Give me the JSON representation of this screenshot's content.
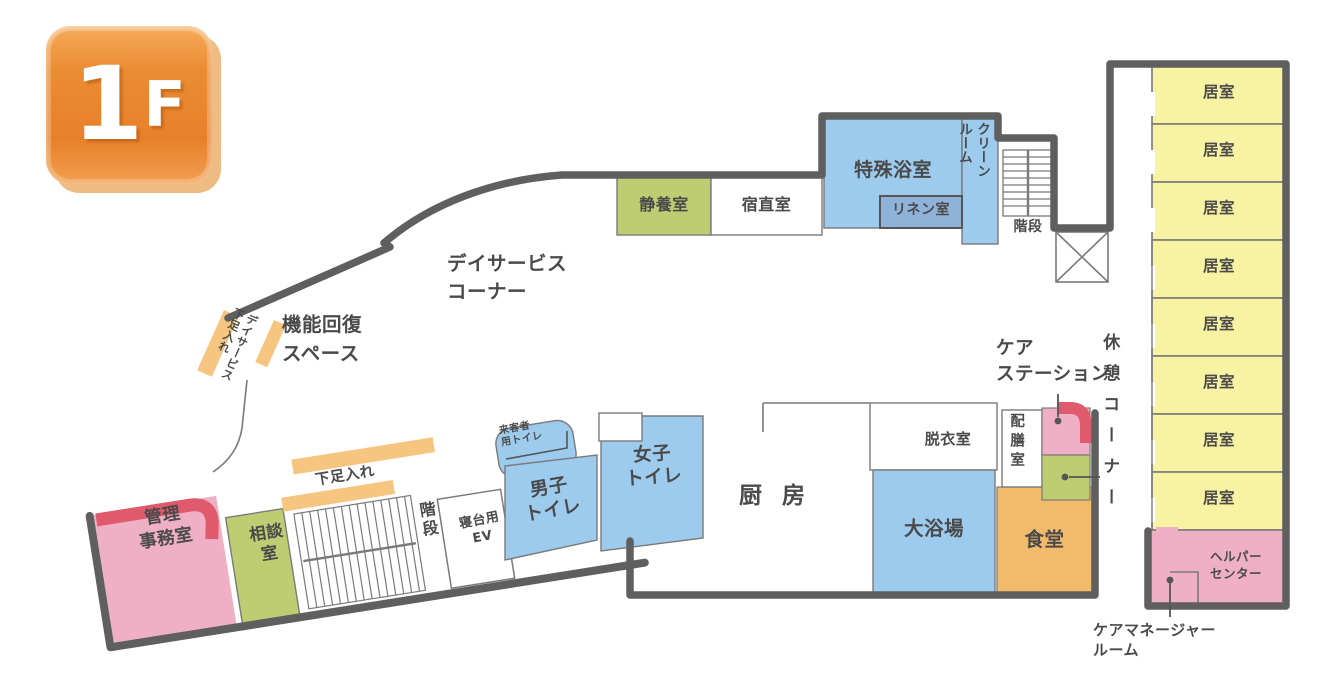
{
  "floor_badge": {
    "number": "1",
    "suffix": "F"
  },
  "colors": {
    "wall_thick": "#5f5f5f",
    "wall_thin": "#7a7a7a",
    "room_yellow": "#f8f2a3",
    "room_blue": "#9dcbee",
    "room_blue_dark": "#8fb2d9",
    "room_green": "#becd72",
    "room_orange": "#f2bb6c",
    "strip_orange": "#f6c57f",
    "room_pink": "#efb0c6",
    "accent_red": "#de5a6c",
    "badge_orange": "#e8862e",
    "label_text": "#4a4a4a"
  },
  "right_wing": {
    "rooms": [
      {
        "label": "居室"
      },
      {
        "label": "居室"
      },
      {
        "label": "居室"
      },
      {
        "label": "居室"
      },
      {
        "label": "居室"
      },
      {
        "label": "居室"
      },
      {
        "label": "居室"
      },
      {
        "label": "居室"
      }
    ],
    "rest_corner": "休憩コーナー",
    "helper_center": "ヘルパー\nセンター",
    "care_manager_room": "ケアマネージャー\nルーム"
  },
  "top_area": {
    "special_bath": "特殊浴室",
    "linen_room": "リネン室",
    "clean_room": "クリーン\nルーム",
    "stairs": "階段",
    "quiet_room": "静養室",
    "night_duty_room": "宿直室"
  },
  "center_area": {
    "day_service_corner": "デイサービス\nコーナー",
    "rehab_space": "機能回復\nスペース",
    "day_service_shoe_rack": "デイサービス\n下足入れ",
    "kitchen": "厨 房",
    "dressing_room": "脱衣室",
    "large_bath": "大浴場",
    "dining_room": "食堂",
    "pantry": "配膳室",
    "care_station": "ケア\nステーション"
  },
  "bottom_left": {
    "admin_office": "管理\n事務室",
    "consulting_room": "相談\n室",
    "shoe_rack": "下足入れ",
    "stairs": "階段",
    "stretcher_elevator": "寝台用\nEV",
    "visitor_toilet": "来客者\n用トイレ",
    "mens_toilet": "男子\nトイレ",
    "womens_toilet": "女子\nトイレ"
  }
}
